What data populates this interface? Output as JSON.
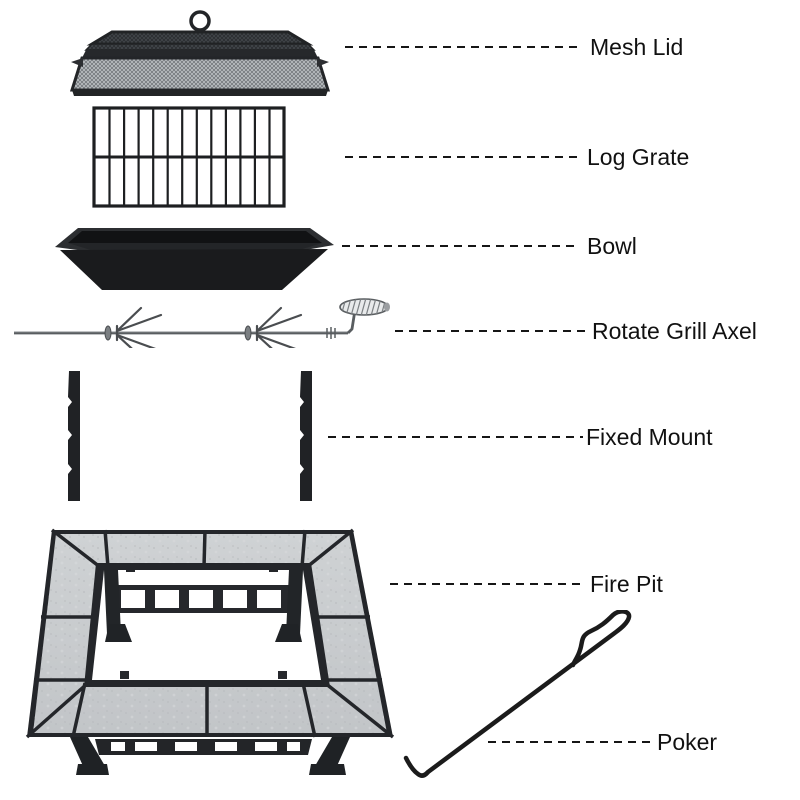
{
  "diagram_type": "exploded-parts-diagram",
  "colors": {
    "background": "#ffffff",
    "line": "#161616",
    "frame_dark": "#24262a",
    "metal_black": "#1b1d1f",
    "steel_gray": "#595d60",
    "tile_gray": "#c8cbce",
    "mesh_light": "#bfc3c6",
    "mesh_dark": "#43474b"
  },
  "parts": [
    {
      "id": "mesh-lid",
      "label": "Mesh Lid",
      "icon": "mesh-lid-illustration"
    },
    {
      "id": "log-grate",
      "label": "Log Grate",
      "icon": "log-grate-illustration"
    },
    {
      "id": "bowl",
      "label": "Bowl",
      "icon": "bowl-illustration"
    },
    {
      "id": "rotate-grill-axel",
      "label": "Rotate Grill Axel",
      "icon": "rotate-grill-axel-illustration"
    },
    {
      "id": "fixed-mount",
      "label": "Fixed Mount",
      "icon": "fixed-mount-illustration"
    },
    {
      "id": "fire-pit",
      "label": "Fire Pit",
      "icon": "fire-pit-illustration"
    },
    {
      "id": "poker",
      "label": "Poker",
      "icon": "poker-illustration"
    }
  ]
}
